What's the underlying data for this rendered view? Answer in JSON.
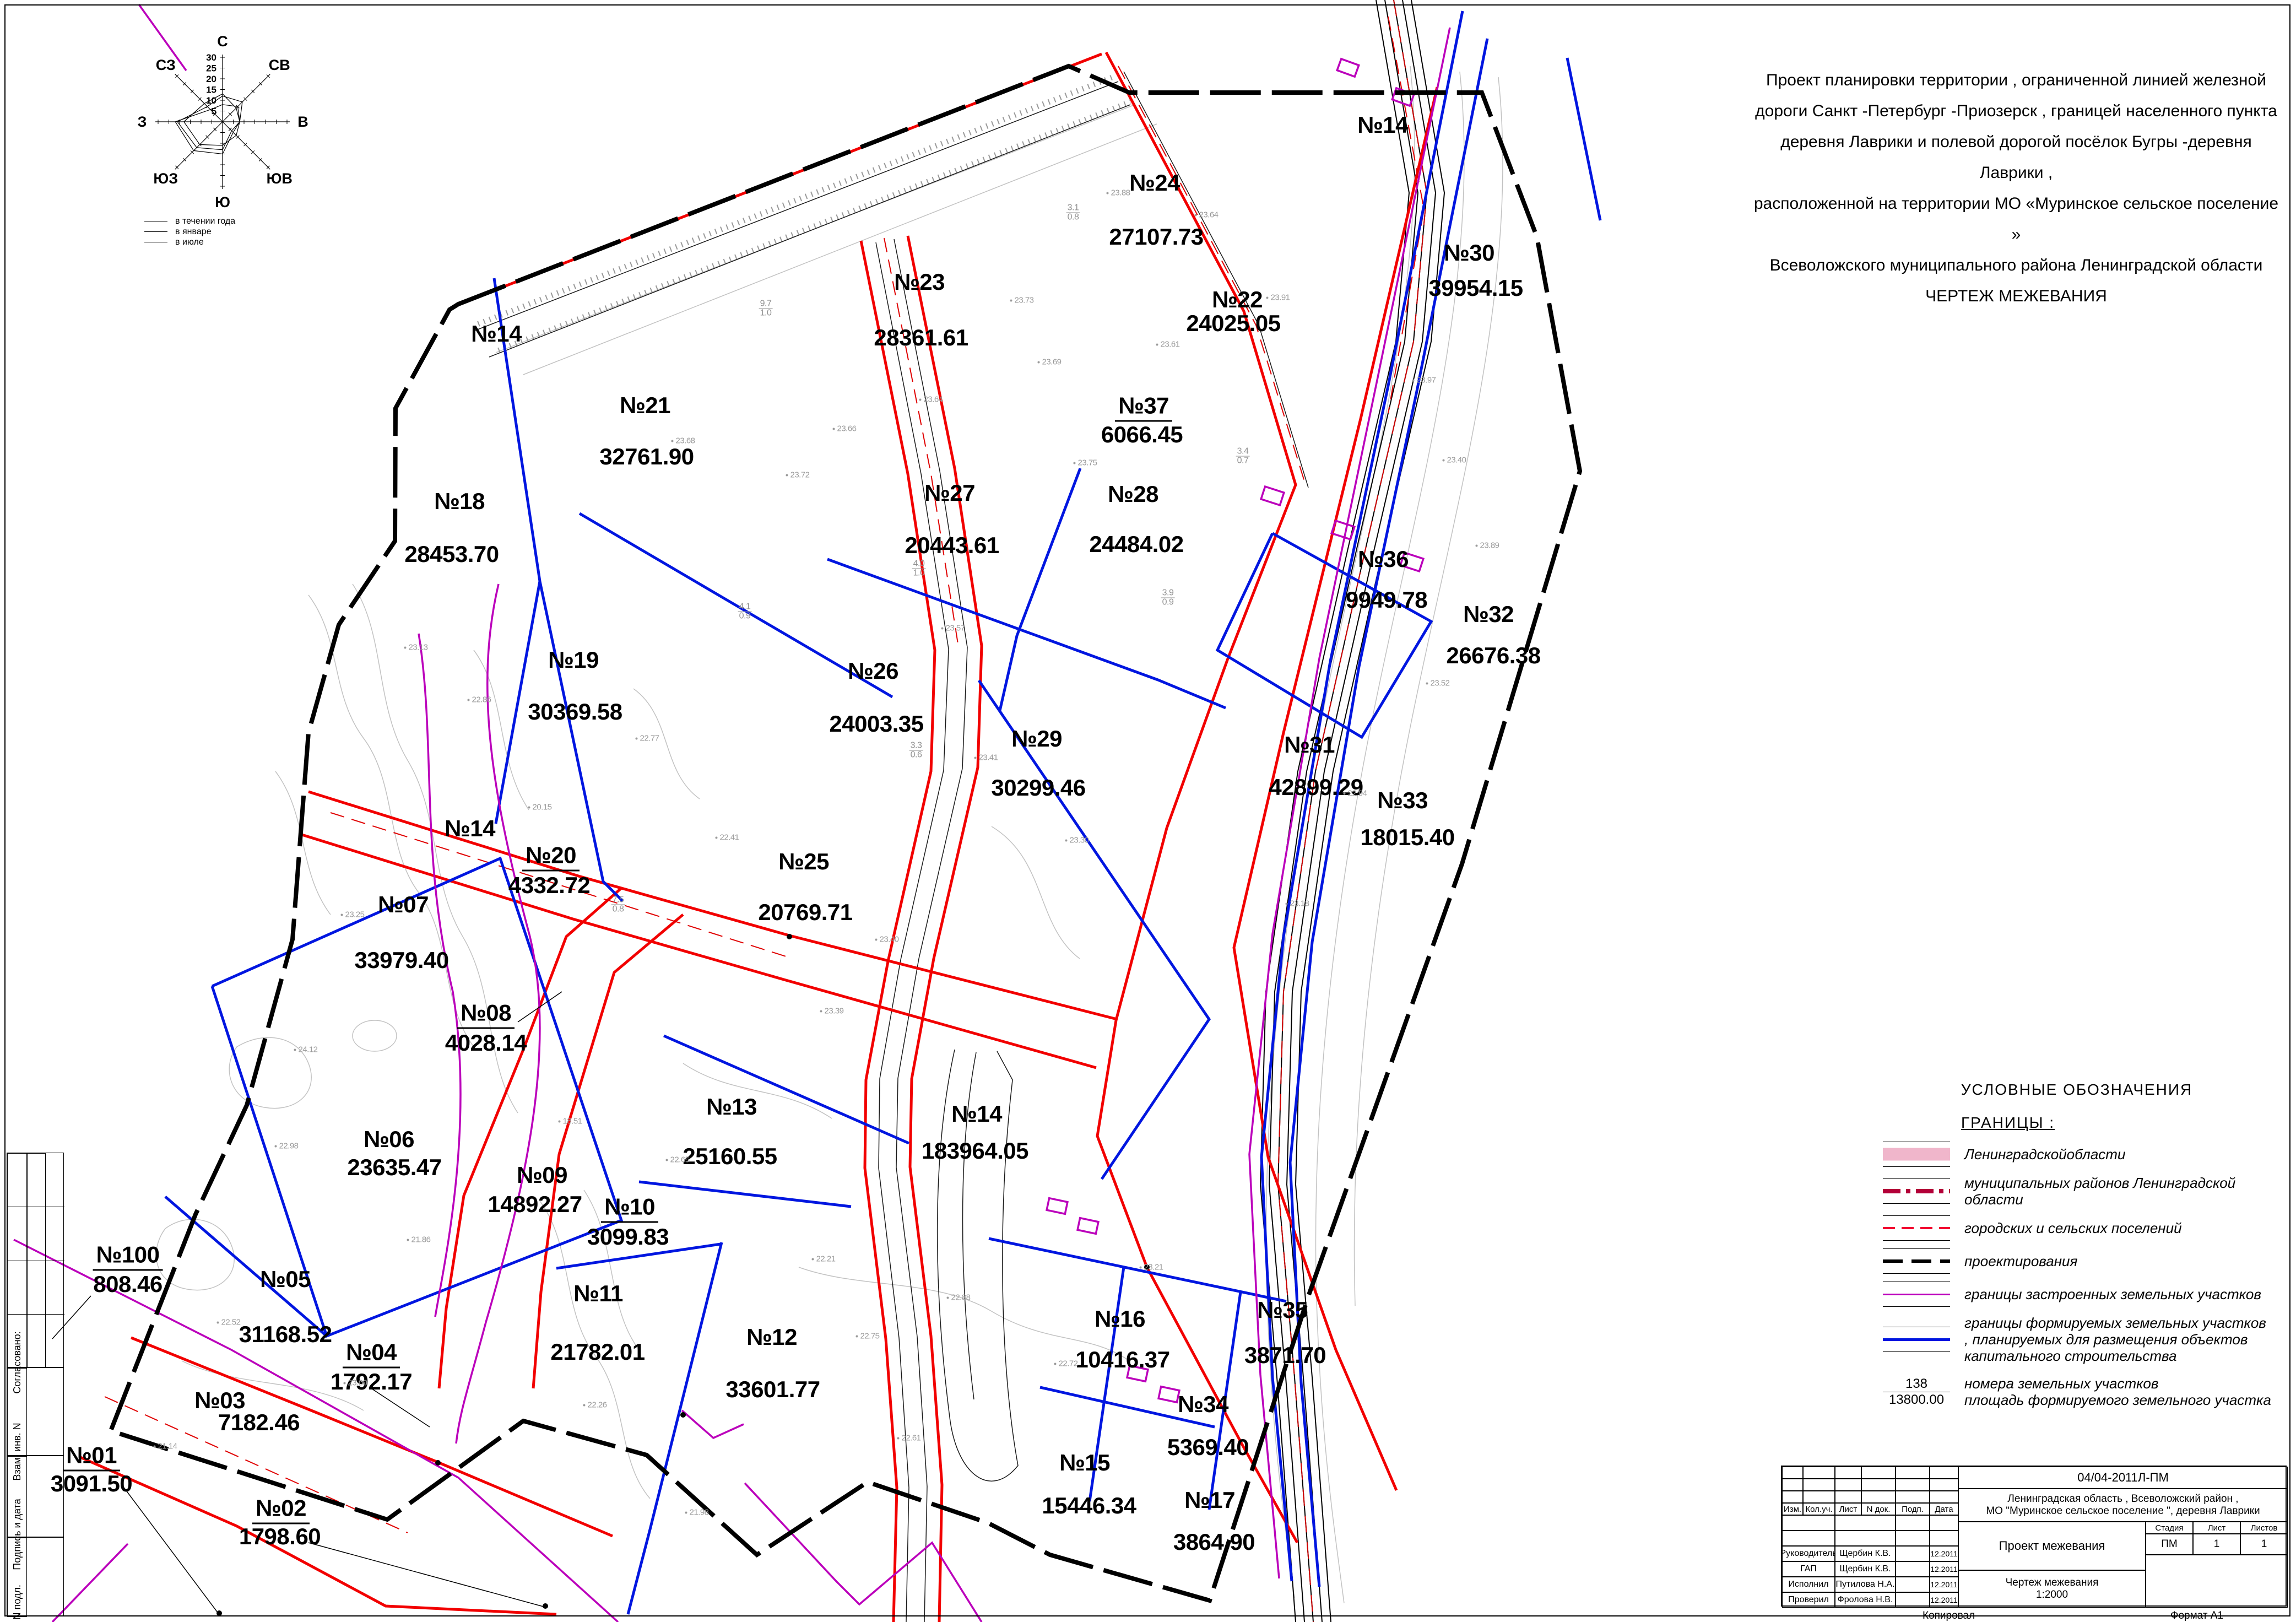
{
  "header_text": {
    "lines": [
      "Проект  планировки  территории , ограниченной  линией  железной",
      "дороги  Санкт -Петербург -Приозерск , границей  населенного  пункта",
      "деревня  Лаврики  и полевой  дорогой  посёлок  Бугры -деревня  Лаврики ,",
      "расположенной  на территории  МО  «Муринское  сельское  поселение »",
      "Всеволожского  муниципального  района  Ленинградской  области",
      "ЧЕРТЕЖ   МЕЖЕВАНИЯ"
    ]
  },
  "wind_rose": {
    "directions": [
      "С",
      "СВ",
      "В",
      "ЮВ",
      "Ю",
      "ЮЗ",
      "З",
      "СЗ"
    ],
    "scale": [
      30,
      25,
      20,
      15,
      10,
      5
    ],
    "series": [
      {
        "name": "в течении года",
        "values": [
          12,
          13,
          8,
          6,
          13,
          17,
          21,
          10
        ]
      },
      {
        "name": "в январе",
        "values": [
          8,
          10,
          8,
          7,
          15,
          19,
          22,
          8
        ]
      },
      {
        "name": "в июле",
        "values": [
          13,
          9,
          8,
          9,
          11,
          15,
          18,
          12
        ]
      }
    ],
    "legend": [
      {
        "label": "в течении  года"
      },
      {
        "label": "в январе"
      },
      {
        "label": "в июле"
      }
    ]
  },
  "chart_data": {
    "type": "line",
    "title": "Роза ветров",
    "categories": [
      "С",
      "СВ",
      "В",
      "ЮВ",
      "Ю",
      "ЮЗ",
      "З",
      "СЗ"
    ],
    "series": [
      {
        "name": "в течении года",
        "values": [
          12,
          13,
          8,
          6,
          13,
          17,
          21,
          10
        ]
      },
      {
        "name": "в январе",
        "values": [
          8,
          10,
          8,
          7,
          15,
          19,
          22,
          8
        ]
      },
      {
        "name": "в июле",
        "values": [
          13,
          9,
          8,
          9,
          11,
          15,
          18,
          12
        ]
      }
    ],
    "ylim": [
      0,
      30
    ]
  },
  "parcels": [
    {
      "no": "№14",
      "x": 901,
      "y": 606
    },
    {
      "no": "№14",
      "x": 2510,
      "y": 227
    },
    {
      "no": "№14",
      "x": 853,
      "y": 1504
    },
    {
      "no": "№14",
      "area": "183964.05",
      "x": 1773,
      "y": 2022,
      "ax": 1770,
      "ay": 2089
    },
    {
      "no": "№21",
      "area": "32761.90",
      "x": 1171,
      "y": 736,
      "ax": 1174,
      "ay": 829
    },
    {
      "no": "№23",
      "area": "28361.61",
      "x": 1669,
      "y": 512,
      "ax": 1672,
      "ay": 613
    },
    {
      "no": "№24",
      "area": "27107.73",
      "x": 2096,
      "y": 332,
      "ax": 2099,
      "ay": 430
    },
    {
      "no": "№22",
      "area": "24025.05",
      "x": 2246,
      "y": 544,
      "ax": 2239,
      "ay": 587
    },
    {
      "no": "№30",
      "area": "39954.15",
      "x": 2667,
      "y": 459,
      "ax": 2679,
      "ay": 523
    },
    {
      "no": "№37",
      "area": "6066.45",
      "x": 2076,
      "y": 739,
      "ax": 2073,
      "ay": 789,
      "f": true
    },
    {
      "no": "№27",
      "area": "20443.61",
      "x": 1724,
      "y": 895,
      "ax": 1728,
      "ay": 990
    },
    {
      "no": "№28",
      "area": "24484.02",
      "x": 2057,
      "y": 897,
      "ax": 2063,
      "ay": 988
    },
    {
      "no": "№18",
      "area": "28453.70",
      "x": 834,
      "y": 910,
      "ax": 820,
      "ay": 1006
    },
    {
      "no": "№19",
      "area": "30369.58",
      "x": 1041,
      "y": 1198,
      "ax": 1044,
      "ay": 1292
    },
    {
      "no": "№26",
      "area": "24003.35",
      "x": 1585,
      "y": 1218,
      "ax": 1591,
      "ay": 1314
    },
    {
      "no": "№29",
      "area": "30299.46",
      "x": 1882,
      "y": 1341,
      "ax": 1885,
      "ay": 1430
    },
    {
      "no": "№36",
      "area": "9949.78",
      "x": 2511,
      "y": 1015,
      "ax": 2517,
      "ay": 1089
    },
    {
      "no": "№32",
      "area": "26676.38",
      "x": 2702,
      "y": 1115,
      "ax": 2711,
      "ay": 1190
    },
    {
      "no": "№31",
      "area": "42899.29",
      "x": 2377,
      "y": 1352,
      "ax": 2389,
      "ay": 1429
    },
    {
      "no": "№33",
      "area": "18015.40",
      "x": 2546,
      "y": 1453,
      "ax": 2555,
      "ay": 1520
    },
    {
      "no": "№20",
      "area": "4332.72",
      "x": 1000,
      "y": 1555,
      "ax": 997,
      "ay": 1607,
      "f": true
    },
    {
      "no": "№25",
      "area": "20769.71",
      "x": 1459,
      "y": 1564,
      "ax": 1462,
      "ay": 1656
    },
    {
      "no": "№07",
      "area": "33979.40",
      "x": 732,
      "y": 1642,
      "ax": 729,
      "ay": 1743
    },
    {
      "no": "№08",
      "area": "4028.14",
      "x": 882,
      "y": 1841,
      "ax": 882,
      "ay": 1893,
      "f": true
    },
    {
      "no": "№06",
      "area": "23635.47",
      "x": 706,
      "y": 2068,
      "ax": 716,
      "ay": 2119
    },
    {
      "no": "№09",
      "area": "14892.27",
      "x": 984,
      "y": 2133,
      "ax": 971,
      "ay": 2186
    },
    {
      "no": "№13",
      "area": "25160.55",
      "x": 1328,
      "y": 2009,
      "ax": 1325,
      "ay": 2099
    },
    {
      "no": "№10",
      "area": "3099.83",
      "x": 1143,
      "y": 2193,
      "ax": 1140,
      "ay": 2245,
      "f": true
    },
    {
      "no": "№05",
      "area": "31168.52",
      "x": 518,
      "y": 2322,
      "ax": 518,
      "ay": 2422
    },
    {
      "no": "№11",
      "area": "21782.01",
      "x": 1086,
      "y": 2348,
      "ax": 1085,
      "ay": 2454
    },
    {
      "no": "№12",
      "area": "33601.77",
      "x": 1401,
      "y": 2427,
      "ax": 1403,
      "ay": 2522
    },
    {
      "no": "№100",
      "area": "808.46",
      "x": 232,
      "y": 2280,
      "ax": 232,
      "ay": 2331,
      "f": true
    },
    {
      "no": "№04",
      "area": "1792.17",
      "x": 674,
      "y": 2457,
      "ax": 674,
      "ay": 2508,
      "f": true
    },
    {
      "no": "№03",
      "area": "7182.46",
      "x": 399,
      "y": 2542,
      "ax": 470,
      "ay": 2582
    },
    {
      "no": "№01",
      "area": "3091.50",
      "x": 166,
      "y": 2644,
      "ax": 166,
      "ay": 2693,
      "f": true
    },
    {
      "no": "№02",
      "area": "1798.60",
      "x": 510,
      "y": 2740,
      "ax": 508,
      "ay": 2789,
      "f": true
    },
    {
      "no": "№16",
      "area": "10416.37",
      "x": 2033,
      "y": 2394,
      "ax": 2038,
      "ay": 2468
    },
    {
      "no": "№35",
      "area": "3871.70",
      "x": 2328,
      "y": 2378,
      "ax": 2333,
      "ay": 2460
    },
    {
      "no": "№34",
      "area": "5369.40",
      "x": 2184,
      "y": 2549,
      "ax": 2193,
      "ay": 2627
    },
    {
      "no": "№15",
      "area": "15446.34",
      "x": 1969,
      "y": 2655,
      "ax": 1977,
      "ay": 2733
    },
    {
      "no": "№17",
      "area": "3864.90",
      "x": 2196,
      "y": 2723,
      "ax": 2204,
      "ay": 2799
    }
  ],
  "zones": [
    {
      "t": "01",
      "x": 706,
      "y": 2001
    },
    {
      "t": "02",
      "x": 1317,
      "y": 2323
    },
    {
      "t": "03",
      "x": 2035,
      "y": 2577
    },
    {
      "t": "04",
      "x": 1004,
      "y": 1020
    },
    {
      "t": "05",
      "x": 1725,
      "y": 1272
    },
    {
      "t": "06",
      "x": 1858,
      "y": 407
    },
    {
      "t": "07",
      "x": 2504,
      "y": 1115
    }
  ],
  "cadastral_labels": [
    {
      "t": "47:07:0722001:332",
      "x": 405,
      "y": 690
    },
    {
      "t": "47:07:0722001:257",
      "x": 1592,
      "y": 827
    },
    {
      "t": "47:07:0722001:258",
      "x": 427,
      "y": 2479
    },
    {
      "t": "47:07:0722001:165",
      "x": 1010,
      "y": 2665
    },
    {
      "t": "47:07:07-22-001:0260-3/2",
      "x": 2105,
      "y": 2092
    }
  ],
  "sold_labels": [
    {
      "t": "продан",
      "x": 1478,
      "y": 1529,
      "color": "#a31545",
      "size": 56
    },
    {
      "t": "продан",
      "x": 1464,
      "y": 2151,
      "color": "#f4506e",
      "size": 58
    },
    {
      "t": "продан",
      "x": 1146,
      "y": 2305,
      "color": "#d03a28",
      "size": 50
    },
    {
      "t": "продан",
      "x": 1372,
      "y": 2629,
      "color": "#7c1240",
      "size": 56
    }
  ],
  "spot_elevations": [
    {
      "v": "23.68",
      "x": 1240,
      "y": 800
    },
    {
      "v": "23.72",
      "x": 1448,
      "y": 862
    },
    {
      "v": "23.66",
      "x": 1533,
      "y": 778
    },
    {
      "v": "23.64",
      "x": 1690,
      "y": 725
    },
    {
      "v": "23.69",
      "x": 1905,
      "y": 657
    },
    {
      "v": "23.75",
      "x": 1970,
      "y": 840
    },
    {
      "v": "23.61",
      "x": 2120,
      "y": 625
    },
    {
      "v": "23.64",
      "x": 2190,
      "y": 390
    },
    {
      "v": "23.88",
      "x": 2030,
      "y": 350
    },
    {
      "v": "23.73",
      "x": 1855,
      "y": 545
    },
    {
      "v": "23.91",
      "x": 2320,
      "y": 540
    },
    {
      "v": "23.97",
      "x": 2585,
      "y": 690
    },
    {
      "v": "23.40",
      "x": 2640,
      "y": 835
    },
    {
      "v": "23.89",
      "x": 2700,
      "y": 990
    },
    {
      "v": "23.52",
      "x": 2610,
      "y": 1240
    },
    {
      "v": "22.94",
      "x": 2460,
      "y": 1440
    },
    {
      "v": "23.18",
      "x": 2355,
      "y": 1640
    },
    {
      "v": "23.57",
      "x": 1730,
      "y": 1140
    },
    {
      "v": "23.41",
      "x": 1790,
      "y": 1375
    },
    {
      "v": "23.30",
      "x": 1955,
      "y": 1525
    },
    {
      "v": "23.40",
      "x": 1610,
      "y": 1705
    },
    {
      "v": "23.39",
      "x": 1510,
      "y": 1835
    },
    {
      "v": "22.41",
      "x": 1320,
      "y": 1520
    },
    {
      "v": "22.77",
      "x": 1175,
      "y": 1340
    },
    {
      "v": "20.15",
      "x": 980,
      "y": 1465
    },
    {
      "v": "22.86",
      "x": 870,
      "y": 1270
    },
    {
      "v": "23.13",
      "x": 755,
      "y": 1175
    },
    {
      "v": "23.25",
      "x": 640,
      "y": 1660
    },
    {
      "v": "24.12",
      "x": 555,
      "y": 1905
    },
    {
      "v": "22.98",
      "x": 520,
      "y": 2080
    },
    {
      "v": "21.86",
      "x": 760,
      "y": 2250
    },
    {
      "v": "18.51",
      "x": 1035,
      "y": 2035
    },
    {
      "v": "22.65",
      "x": 1230,
      "y": 2105
    },
    {
      "v": "22.21",
      "x": 1495,
      "y": 2285
    },
    {
      "v": "22.75",
      "x": 1575,
      "y": 2425
    },
    {
      "v": "22.88",
      "x": 1740,
      "y": 2355
    },
    {
      "v": "22.72",
      "x": 1935,
      "y": 2475
    },
    {
      "v": "23.21",
      "x": 2090,
      "y": 2300
    },
    {
      "v": "23.00",
      "x": 645,
      "y": 2510
    },
    {
      "v": "22.52",
      "x": 415,
      "y": 2400
    },
    {
      "v": "21.14",
      "x": 300,
      "y": 2625
    },
    {
      "v": "22.26",
      "x": 1080,
      "y": 2550
    },
    {
      "v": "21.98",
      "x": 1265,
      "y": 2745
    },
    {
      "v": "22.61",
      "x": 1650,
      "y": 2610
    }
  ],
  "annotations": [
    {
      "n": "3.1",
      "d": "0.8",
      "x": 1948,
      "y": 386
    },
    {
      "n": "9.7",
      "d": "1.0",
      "x": 1390,
      "y": 560
    },
    {
      "n": "3.4",
      "d": "0.7",
      "x": 2256,
      "y": 828
    },
    {
      "n": "4.0",
      "d": "1.0",
      "x": 1668,
      "y": 1032
    },
    {
      "n": "7.5",
      "d": "0.8",
      "x": 1122,
      "y": 1642
    },
    {
      "n": "3.3",
      "d": "0.6",
      "x": 1663,
      "y": 1362
    },
    {
      "n": "4.1",
      "d": "0.9",
      "x": 1352,
      "y": 1110
    },
    {
      "n": "3.9",
      "d": "0.9",
      "x": 2120,
      "y": 1085
    }
  ],
  "legend": {
    "title": "УСЛОВНЫЕ  ОБОЗНАЧЕНИЯ",
    "subtitle": "ГРАНИЦЫ  :",
    "items": [
      {
        "label": "Ленинградскойобласти"
      },
      {
        "label": "муниципальных  районов  Ленинградской области"
      },
      {
        "label": "городских и сельских поселений"
      },
      {
        "label": "проектирования"
      },
      {
        "label": "границы  застроенных  земельных  участков"
      },
      {
        "label": "границы  формируемых  земельных  участков , планируемых  для  размещения  объектов капитального  строительства"
      }
    ],
    "numbers": {
      "no": "138",
      "area": "13800.00",
      "label_no": "номера  земельных  участков",
      "label_area": "площадь формируемого  земельного  участка"
    }
  },
  "title_block": {
    "code": "04/04-2011Л-ПМ",
    "location_line1": "Ленинградская  область , Всеволожский  район ,",
    "location_line2": "МО  \"Муринское  сельское  поселение \", деревня Лаврики",
    "header_cols": [
      "Изм.",
      "Кол.уч.",
      "Лист",
      "N док.",
      "Подп.",
      "Дата"
    ],
    "rows": [
      {
        "role": "Руководитель",
        "name": "Щербин К.В.",
        "date": "12.2011"
      },
      {
        "role": "ГАП",
        "name": "Щербин К.В.",
        "date": "12.2011"
      },
      {
        "role": "Исполнил",
        "name": "Путилова Н.А.",
        "date": "12.2011"
      },
      {
        "role": "Проверил",
        "name": "Фролова Н.В.",
        "date": "12.2011"
      }
    ],
    "project": "Проект  межевания",
    "stage_cols": [
      "Стадия",
      "Лист",
      "Листов"
    ],
    "stage_vals": [
      "ПМ",
      "1",
      "1"
    ],
    "drawing": "Чертеж межевания",
    "drawing_scale": "1:2000",
    "copied": "Копировал",
    "format": "Формат А1"
  },
  "frame": {
    "strip": [
      "Согласовано:",
      "Взам. инв. N",
      "Подпись и дата",
      "Инв. N подл."
    ]
  },
  "colors": {
    "road_red": "#f20000",
    "formed_blue": "#0016e0",
    "built_magenta": "#bb00bb",
    "cadastral_magenta": "#c400c4",
    "boundary_black": "#000000",
    "contour_gray": "#c2c2c2",
    "oblast_pink": "#f0b6cb",
    "municipal_darkred": "#b30038"
  }
}
